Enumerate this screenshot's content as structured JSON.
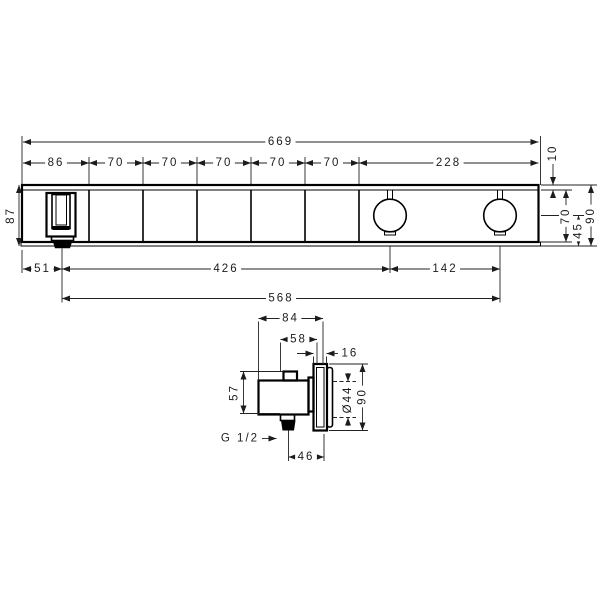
{
  "drawing": {
    "front_view": {
      "width_total": "669",
      "segments": [
        "86",
        "70",
        "70",
        "70",
        "70",
        "70",
        "228"
      ],
      "edge_offset": "10",
      "height_left": "87",
      "face_height": "70",
      "center_to_bottom": "45",
      "height_right": "90",
      "outlet_offset": "51",
      "outlet_to_first_knob": "426",
      "knob_spacing": "142",
      "outlet_to_second_knob": "568"
    },
    "side_view": {
      "depth_total": "84",
      "depth_body": "58",
      "front_projection": "16",
      "body_height": "57",
      "knob_diameter": "Ø44",
      "plate_height": "90",
      "thread_size": "G 1/2",
      "axis_to_front": "46"
    }
  }
}
